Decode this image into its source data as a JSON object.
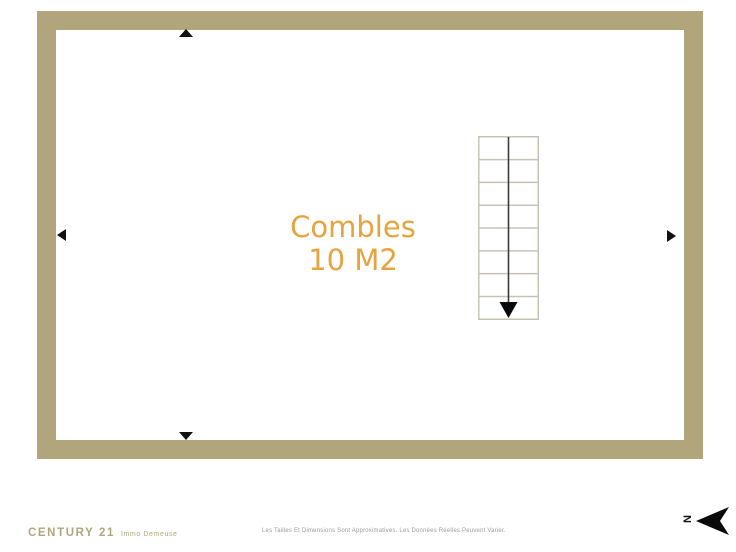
{
  "plan": {
    "room_label": {
      "name": "Combles",
      "area": "10 M2"
    },
    "wall_color": "#b1a57b",
    "label_color": "#e6a33e",
    "stair_color": "#c6c3b5",
    "stairs": {
      "steps": 8,
      "direction": "down"
    },
    "markers": [
      "up",
      "down",
      "left",
      "right"
    ]
  },
  "footer": {
    "brand": "CENTURY 21",
    "agency": "Immo Demeuse",
    "disclaimer": "Les Tailles Et Dimensions Sont Approximatives. Les Données Réelles Peuvent Varier.",
    "compass_letter": "N"
  }
}
